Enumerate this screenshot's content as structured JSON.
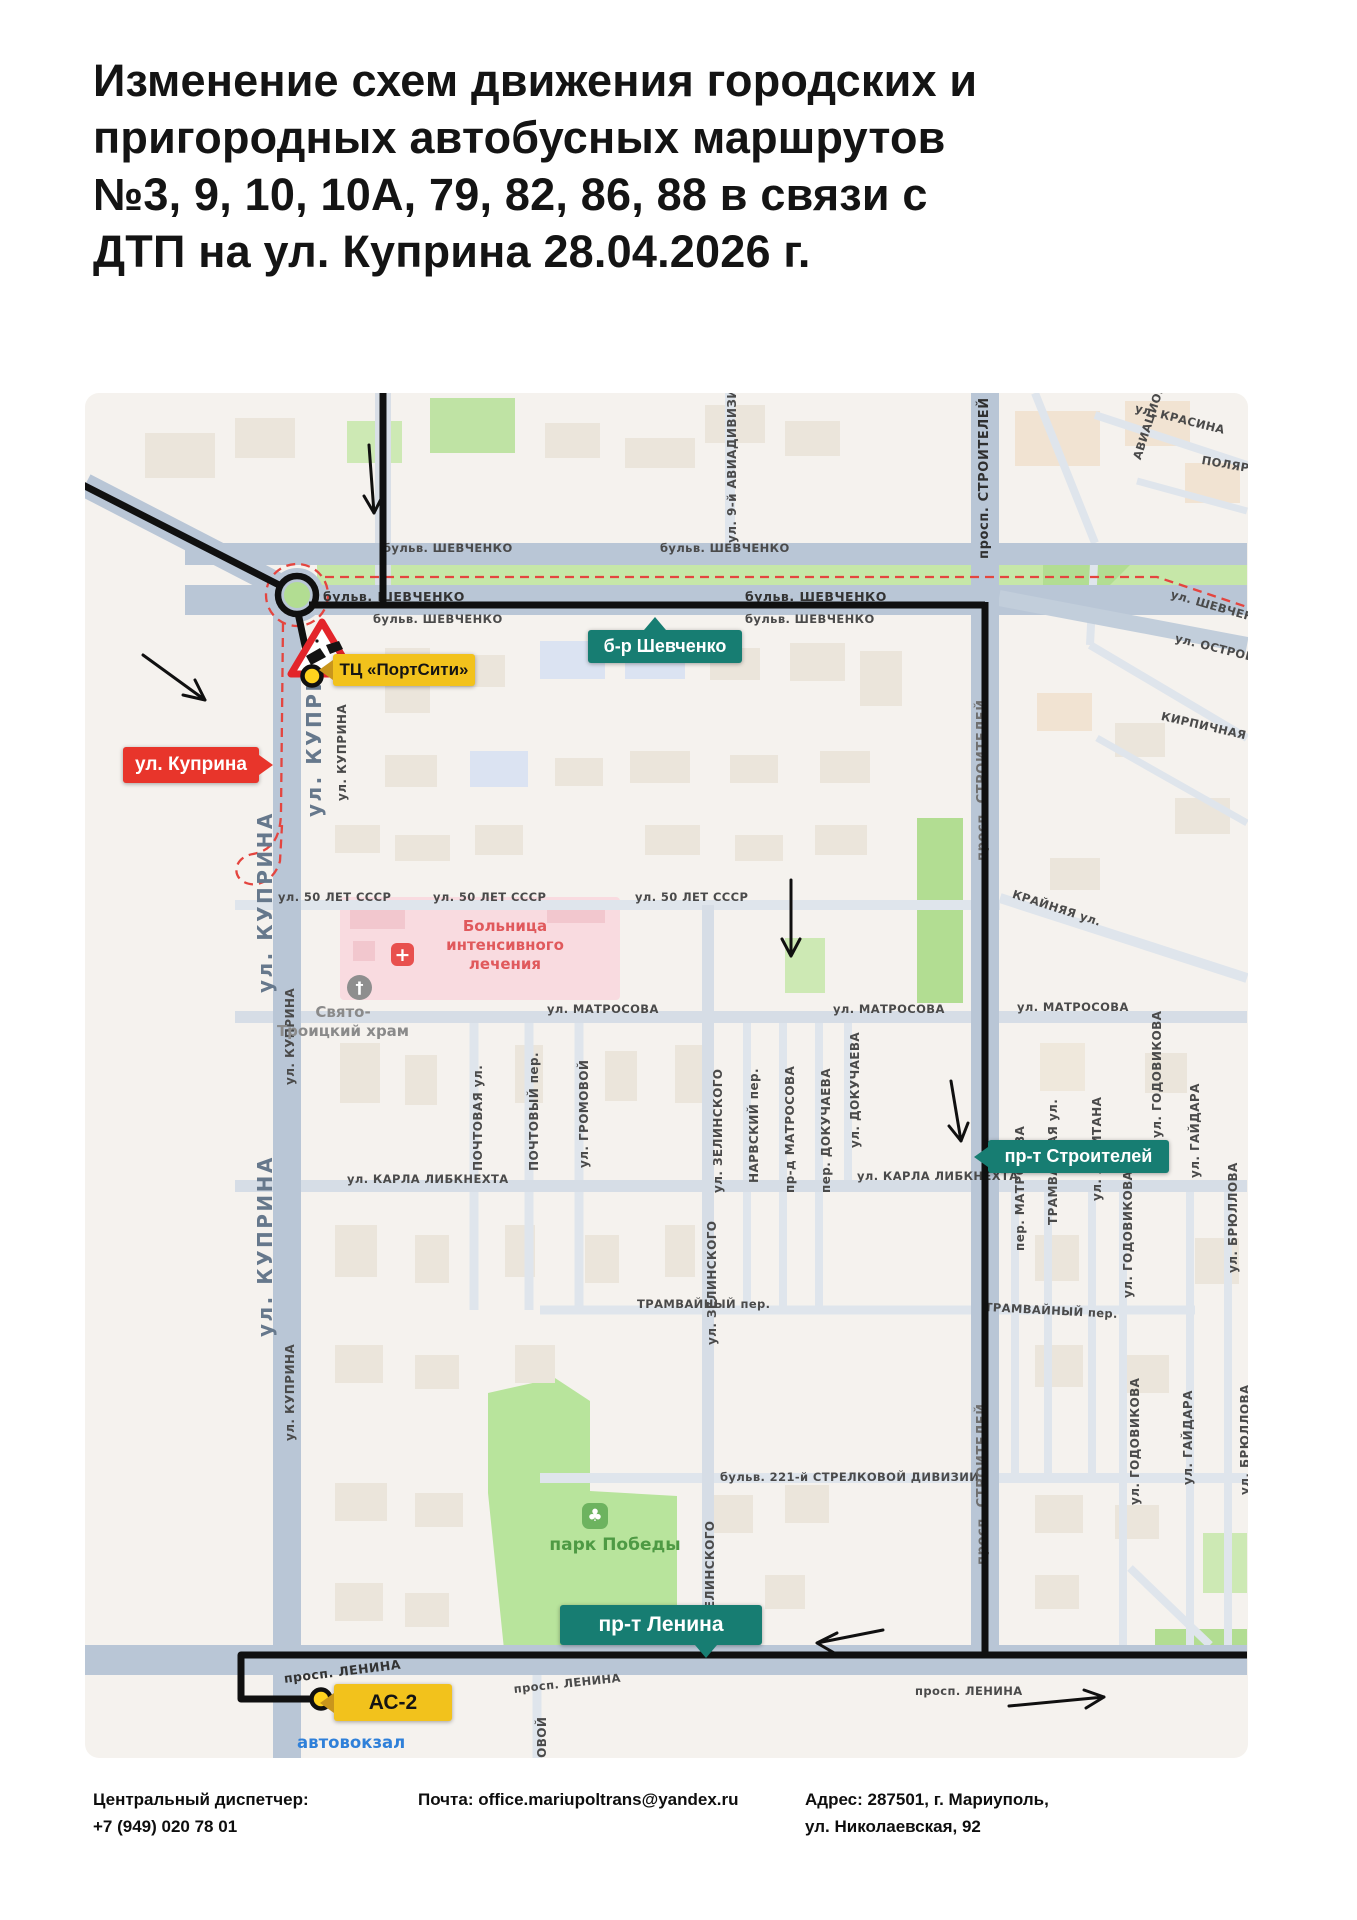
{
  "title": {
    "lines": [
      "Изменение схем движения городских и",
      "пригородных автобусных маршрутов",
      "№3, 9, 10, 10А, 79, 82, 86, 88 в связи с",
      "ДТП на ул. Куприна 28.04.2026 г."
    ]
  },
  "map": {
    "callouts": {
      "portcity": "ТЦ «ПортСити»",
      "kuprina": "ул. Куприна",
      "shevchenko": "б-р Шевченко",
      "stroiteley": "пр-т Строителей",
      "lenina": "пр-т Ленина",
      "as2": "АС-2"
    },
    "pois": {
      "hospital_line1": "Больница",
      "hospital_line2": "интенсивного",
      "hospital_line3": "лечения",
      "church_line1": "Свято-",
      "church_line2": "Троицкий храм",
      "park": "парк Победы",
      "bus_station": "автовокзал"
    },
    "street_labels": [
      "бульв. ШЕВЧЕНКО",
      "бульв. ШЕВЧЕНКО",
      "бульв. ШЕВЧЕНКО",
      "бульв. ШЕВЧЕНКО",
      "бульв. ШЕВЧЕНКО",
      "бульв. ШЕВЧЕНКО",
      "ул. 50 ЛЕТ СССР",
      "ул. 50 ЛЕТ СССР",
      "ул. 50 ЛЕТ СССР",
      "КРАЙНЯЯ ул.",
      "ул. МАТРОСОВА",
      "ул. МАТРОСОВА",
      "ул. МАТРОСОВА",
      "ул. КАРЛА ЛИБКНЕХТА",
      "ул. КАРЛА ЛИБКНЕХТА",
      "ТРАМВАЙНЫЙ пер.",
      "ТРАМВАЙНЫЙ пер.",
      "бульв. 221-й СТРЕЛКОВОЙ ДИВИЗИИ",
      "просп. ЛЕНИНА",
      "просп. ЛЕНИНА",
      "просп. ЛЕНИНА",
      "ул. КРАСИНА",
      "ПОЛЯРНАЯ",
      "АВИАЦИОННАЯ",
      "ул. ШЕВЧЕНКО",
      "ул. ОСТРОВСКОГО",
      "КИРПИЧНАЯ",
      "ул. 9-й АВИАДИВИЗИИ",
      "просп. СТРОИТЕЛЕЙ",
      "просп. СТРОИТЕЛЕЙ",
      "просп. СТРОИТЕЛЕЙ",
      "ул. КУПРИНА",
      "ул. КУПРИНА",
      "ул. КУПРИНА",
      "ул. КУПРИНА",
      "ул. КУПРИНА",
      "ул. КУПРИНА",
      "ПОЧТОВАЯ ул.",
      "ПОЧТОВЫЙ пер.",
      "ул. ГРОМОВОЙ",
      "ул. ЗЕЛИНСКОГО",
      "НАРВСКИЙ пер.",
      "пр-д МАТРОСОВА",
      "пер. ДОКУЧАЕВА",
      "ул. ДОКУЧАЕВА",
      "ул. ЗЕЛИНСКОГО",
      "ул. ЗЕЛИНСКОГО",
      "пер. МАТРОСОВА",
      "ТРАМВАЙНАЯ ул.",
      "ул. ЛЕВИТАНА",
      "ул. ГОДОВИКОВА",
      "ул. ГОДОВИКОВА",
      "ул. ГАЙДАРА",
      "ул. ГАЙДАРА",
      "ул. БРЮЛЛОВА",
      "ул. БРЮЛЛОВА",
      "ул. ГОДОВИКОВА",
      "ул. ГРОМОВОЙ"
    ],
    "colors": {
      "route": "#101010",
      "closed_route_dash": "#e4453f",
      "callout_teal": "#177d72",
      "callout_yellow": "#f2c21c",
      "callout_red": "#e8352b",
      "stop_fill": "#ffd21e"
    }
  },
  "footer": {
    "dispatcher_label": "Центральный диспетчер:",
    "dispatcher_phone": "+7 (949) 020 78 01",
    "email": "Почта: office.mariupoltrans@yandex.ru",
    "address_line1": "Адрес: 287501, г. Мариуполь,",
    "address_line2": "ул. Николаевская, 92"
  }
}
